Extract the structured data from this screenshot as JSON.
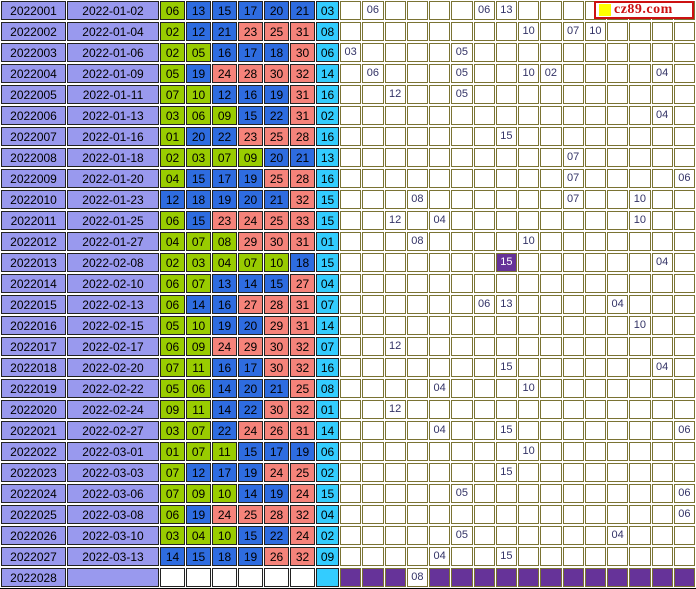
{
  "logo": {
    "text": "cz89.com",
    "square_color": "#ffff00",
    "text_color": "#cc1111",
    "border_color": "#cc1111"
  },
  "colors": {
    "label_bg": "#9999ee",
    "zone1_green": "#99cc00",
    "zone2_blue": "#2e6ce0",
    "zone3_salmon": "#f5837a",
    "blue_ball_cyan": "#33ccff",
    "purple": "#663399",
    "grid_text": "#333366",
    "grid_border": "#7a7333",
    "panel_border": "#222222"
  },
  "zones": {
    "green_max": 11,
    "blue_max": 22,
    "red_max": 33
  },
  "grid_columns": 16,
  "rows": [
    {
      "issue": "2022001",
      "date": "2022-01-02",
      "reds": [
        "06",
        "13",
        "15",
        "17",
        "20",
        "21"
      ],
      "blue": "03",
      "cells": [
        {
          "c": 2,
          "v": "06"
        },
        {
          "c": 7,
          "v": "06"
        },
        {
          "c": 8,
          "v": "13"
        }
      ]
    },
    {
      "issue": "2022002",
      "date": "2022-01-04",
      "reds": [
        "02",
        "12",
        "21",
        "23",
        "25",
        "31"
      ],
      "blue": "08",
      "cells": [
        {
          "c": 9,
          "v": "10"
        },
        {
          "c": 11,
          "v": "07"
        },
        {
          "c": 12,
          "v": "10"
        }
      ]
    },
    {
      "issue": "2022003",
      "date": "2022-01-06",
      "reds": [
        "02",
        "05",
        "16",
        "17",
        "18",
        "30"
      ],
      "blue": "06",
      "cells": [
        {
          "c": 1,
          "v": "03"
        },
        {
          "c": 6,
          "v": "05"
        }
      ]
    },
    {
      "issue": "2022004",
      "date": "2022-01-09",
      "reds": [
        "05",
        "19",
        "24",
        "28",
        "30",
        "32"
      ],
      "blue": "14",
      "cells": [
        {
          "c": 2,
          "v": "06"
        },
        {
          "c": 6,
          "v": "05"
        },
        {
          "c": 9,
          "v": "10"
        },
        {
          "c": 10,
          "v": "02"
        },
        {
          "c": 15,
          "v": "04"
        }
      ]
    },
    {
      "issue": "2022005",
      "date": "2022-01-11",
      "reds": [
        "07",
        "10",
        "12",
        "16",
        "19",
        "31"
      ],
      "blue": "16",
      "cells": [
        {
          "c": 3,
          "v": "12"
        },
        {
          "c": 6,
          "v": "05"
        }
      ]
    },
    {
      "issue": "2022006",
      "date": "2022-01-13",
      "reds": [
        "03",
        "06",
        "09",
        "15",
        "22",
        "31"
      ],
      "blue": "02",
      "cells": [
        {
          "c": 15,
          "v": "04"
        }
      ]
    },
    {
      "issue": "2022007",
      "date": "2022-01-16",
      "reds": [
        "01",
        "20",
        "22",
        "23",
        "25",
        "28"
      ],
      "blue": "16",
      "cells": [
        {
          "c": 8,
          "v": "15"
        }
      ]
    },
    {
      "issue": "2022008",
      "date": "2022-01-18",
      "reds": [
        "02",
        "03",
        "07",
        "09",
        "20",
        "21"
      ],
      "blue": "13",
      "cells": [
        {
          "c": 11,
          "v": "07"
        }
      ]
    },
    {
      "issue": "2022009",
      "date": "2022-01-20",
      "reds": [
        "04",
        "15",
        "17",
        "19",
        "25",
        "28"
      ],
      "blue": "16",
      "cells": [
        {
          "c": 11,
          "v": "07"
        },
        {
          "c": 16,
          "v": "06"
        }
      ]
    },
    {
      "issue": "2022010",
      "date": "2022-01-23",
      "reds": [
        "12",
        "18",
        "19",
        "20",
        "21",
        "32"
      ],
      "blue": "15",
      "cells": [
        {
          "c": 4,
          "v": "08"
        },
        {
          "c": 11,
          "v": "07"
        },
        {
          "c": 14,
          "v": "10"
        }
      ]
    },
    {
      "issue": "2022011",
      "date": "2022-01-25",
      "reds": [
        "06",
        "15",
        "23",
        "24",
        "25",
        "33"
      ],
      "blue": "15",
      "cells": [
        {
          "c": 3,
          "v": "12"
        },
        {
          "c": 5,
          "v": "04"
        },
        {
          "c": 14,
          "v": "10"
        }
      ]
    },
    {
      "issue": "2022012",
      "date": "2022-01-27",
      "reds": [
        "04",
        "07",
        "08",
        "29",
        "30",
        "31"
      ],
      "blue": "01",
      "cells": [
        {
          "c": 4,
          "v": "08"
        },
        {
          "c": 9,
          "v": "10"
        }
      ]
    },
    {
      "issue": "2022013",
      "date": "2022-02-08",
      "reds": [
        "02",
        "03",
        "04",
        "07",
        "10",
        "18"
      ],
      "blue": "15",
      "cells": [
        {
          "c": 8,
          "v": "15",
          "hl": true
        },
        {
          "c": 15,
          "v": "04"
        }
      ]
    },
    {
      "issue": "2022014",
      "date": "2022-02-10",
      "reds": [
        "06",
        "07",
        "13",
        "14",
        "15",
        "27"
      ],
      "blue": "04",
      "cells": []
    },
    {
      "issue": "2022015",
      "date": "2022-02-13",
      "reds": [
        "06",
        "14",
        "16",
        "27",
        "28",
        "31"
      ],
      "blue": "07",
      "cells": [
        {
          "c": 7,
          "v": "06"
        },
        {
          "c": 8,
          "v": "13"
        },
        {
          "c": 13,
          "v": "04"
        }
      ]
    },
    {
      "issue": "2022016",
      "date": "2022-02-15",
      "reds": [
        "05",
        "10",
        "19",
        "20",
        "29",
        "31"
      ],
      "blue": "14",
      "cells": [
        {
          "c": 14,
          "v": "10"
        }
      ]
    },
    {
      "issue": "2022017",
      "date": "2022-02-17",
      "reds": [
        "06",
        "09",
        "24",
        "29",
        "30",
        "32"
      ],
      "blue": "07",
      "cells": [
        {
          "c": 3,
          "v": "12"
        }
      ]
    },
    {
      "issue": "2022018",
      "date": "2022-02-20",
      "reds": [
        "07",
        "11",
        "16",
        "17",
        "30",
        "32"
      ],
      "blue": "16",
      "cells": [
        {
          "c": 8,
          "v": "15"
        },
        {
          "c": 15,
          "v": "04"
        }
      ]
    },
    {
      "issue": "2022019",
      "date": "2022-02-22",
      "reds": [
        "05",
        "06",
        "14",
        "20",
        "21",
        "25"
      ],
      "blue": "08",
      "cells": [
        {
          "c": 5,
          "v": "04"
        },
        {
          "c": 9,
          "v": "10"
        }
      ]
    },
    {
      "issue": "2022020",
      "date": "2022-02-24",
      "reds": [
        "09",
        "11",
        "14",
        "22",
        "30",
        "32"
      ],
      "blue": "01",
      "cells": [
        {
          "c": 3,
          "v": "12"
        }
      ]
    },
    {
      "issue": "2022021",
      "date": "2022-02-27",
      "reds": [
        "03",
        "07",
        "22",
        "24",
        "26",
        "31"
      ],
      "blue": "14",
      "cells": [
        {
          "c": 5,
          "v": "04"
        },
        {
          "c": 8,
          "v": "15"
        },
        {
          "c": 16,
          "v": "06"
        }
      ]
    },
    {
      "issue": "2022022",
      "date": "2022-03-01",
      "reds": [
        "01",
        "07",
        "11",
        "15",
        "17",
        "19"
      ],
      "blue": "06",
      "cells": [
        {
          "c": 9,
          "v": "10"
        }
      ]
    },
    {
      "issue": "2022023",
      "date": "2022-03-03",
      "reds": [
        "07",
        "12",
        "17",
        "19",
        "24",
        "25"
      ],
      "blue": "02",
      "cells": [
        {
          "c": 8,
          "v": "15"
        }
      ]
    },
    {
      "issue": "2022024",
      "date": "2022-03-06",
      "reds": [
        "07",
        "09",
        "10",
        "14",
        "19",
        "24"
      ],
      "blue": "15",
      "cells": [
        {
          "c": 6,
          "v": "05"
        },
        {
          "c": 16,
          "v": "06"
        }
      ]
    },
    {
      "issue": "2022025",
      "date": "2022-03-08",
      "reds": [
        "06",
        "19",
        "24",
        "25",
        "28",
        "32"
      ],
      "blue": "04",
      "cells": [
        {
          "c": 16,
          "v": "06"
        }
      ]
    },
    {
      "issue": "2022026",
      "date": "2022-03-10",
      "reds": [
        "03",
        "04",
        "10",
        "15",
        "22",
        "24"
      ],
      "blue": "02",
      "cells": [
        {
          "c": 6,
          "v": "05"
        },
        {
          "c": 13,
          "v": "04"
        }
      ]
    },
    {
      "issue": "2022027",
      "date": "2022-03-13",
      "reds": [
        "14",
        "15",
        "18",
        "19",
        "26",
        "32"
      ],
      "blue": "09",
      "cells": [
        {
          "c": 5,
          "v": "04"
        },
        {
          "c": 8,
          "v": "15"
        }
      ]
    },
    {
      "issue": "2022028",
      "date": "",
      "reds": [
        "",
        "",
        "",
        "",
        "",
        ""
      ],
      "blue": "",
      "pending": true,
      "cells": [
        {
          "c": 4,
          "v": "08"
        }
      ]
    }
  ]
}
